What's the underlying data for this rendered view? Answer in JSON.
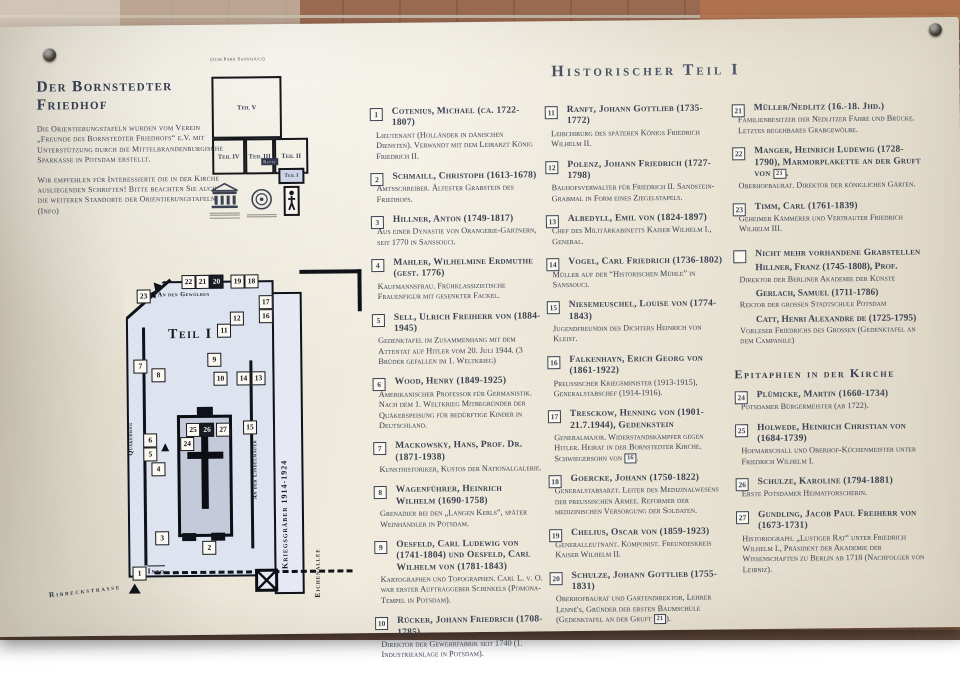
{
  "header": {
    "title": "Der Bornstedter Friedhof",
    "para1": "Die Orientierungstafeln wurden vom Verein „Freunde des Bornstedter Friedhofs“ e.V. mit Unterstützung durch die Mittelbrandenburgische Sparkasse in Potsdam erstellt.",
    "para2": "Wir empfehlen für Interessierte die in der Kirche ausliegenden Schriften! Bitte beachten Sie auch die weiteren Standorte der Orientierungstafeln (Info)"
  },
  "overview_map": {
    "caption": "(zum Park Sanssouci)",
    "rooms": {
      "v": "Teil V",
      "iv": "Teil IV",
      "iii": "Teil III",
      "ii": "Teil II"
    },
    "you_are_here": "Teil I",
    "small_label": "Kette"
  },
  "main_title": "Historischer Teil I",
  "columns": {
    "col1": [
      {
        "n": "1",
        "name": "Cotenius, Michael (ca. 1722-1807)",
        "desc": "Lieutenant (Holländer in dänischen Diensten). Verwandt mit dem Leibarzt König Friedrich II."
      },
      {
        "n": "2",
        "name": "Schmaill, Christoph (1613-1678)",
        "desc": "Amtsschreiber. Ältester Grabstein des Friedhofs."
      },
      {
        "n": "3",
        "name": "Hillner, Anton (1749-1817)",
        "desc": "Aus einer Dynastie von Orangerie-Gärtnern, seit 1770 in Sanssouci."
      },
      {
        "n": "4",
        "name": "Mahler, Wilhelmine Erdmuthe (gest. 1776)",
        "desc": "Kaufmannsfrau. Frühklassizistische Frauenfigur mit gesenkter Fackel."
      },
      {
        "n": "5",
        "name": "Sell, Ulrich Freiherr von (1884-1945)",
        "desc": "Gedenktafel im Zusammenhang mit dem Attentat auf Hitler vom 20. Juli 1944. (3 Brüder gefallen im 1. Weltkrieg)"
      },
      {
        "n": "6",
        "name": "Wood, Henry (1849-1925)",
        "desc": "Amerikanischer Professor für Germanistik. Nach dem 1. Weltkrieg Mitbegründer der Quäkerspeisung für bedürftige Kinder in Deutschland."
      },
      {
        "n": "7",
        "name": "Mackowsky, Hans, Prof. Dr. (1871-1938)",
        "desc": "Kunsthistoriker, Kustos der Nationalgalerie."
      },
      {
        "n": "8",
        "name": "Wagenführer, Heinrich Wilhelm (1690-1758)",
        "desc": "Grenadier bei den „Langen Kerls“, später Weinhändler in Potsdam."
      },
      {
        "n": "9",
        "name": "Oesfeld, Carl Ludewig von (1741-1804) und Oesfeld, Carl Wilhelm von (1781-1843)",
        "desc": "Kartographen und Topographen. Carl L. v. O. war erster Auftraggeber Schinkels (Pomona-Tempel in Potsdam)."
      },
      {
        "n": "10",
        "name": "Rücker, Johann Friedrich (1708-1785)",
        "desc": "Direktor der Gewehrfabrik seit 1740 (1. Industrieanlage in Potsdam)."
      }
    ],
    "col2": [
      {
        "n": "11",
        "name": "Ranft, Johann Gottlieb (1735-1772)",
        "desc": "Leibchirurg des späteren Königs Friedrich Wilhelm II."
      },
      {
        "n": "12",
        "name": "Polenz, Johann Friedrich (1727-1798)",
        "desc": "Bauhofsverwalter für Friedrich II. Sandstein-Grabmal in Form eines Ziegelstapels."
      },
      {
        "n": "13",
        "name": "Albedyll, Emil von (1824-1897)",
        "desc": "Chef des Militärkabinetts Kaiser Wilhelm I., General."
      },
      {
        "n": "14",
        "name": "Vogel, Carl Friedrich (1736-1802)",
        "desc": "Müller auf der “Historischen Mühle” in Sanssouci."
      },
      {
        "n": "15",
        "name": "Niesemeuschel, Louise von (1774-1843)",
        "desc": "Jugendfreundin des Dichters Heinrich von Kleist."
      },
      {
        "n": "16",
        "name": "Falkenhayn, Erich Georg von (1861-1922)",
        "desc": "Preußischer Kriegsminister (1913-1915), Generalstabschef (1914-1916)."
      },
      {
        "n": "17",
        "name": "Tresckow, Henning von (1901-21.7.1944), Gedenkstein",
        "desc": "Generalmajor. Widerstandskämpfer gegen Hitler. Heirat in der Bornstedter Kirche. Schwiegersohn von [16]."
      },
      {
        "n": "18",
        "name": "Goercke, Johann (1750-1822)",
        "desc": "Generalstabsarzt. Leiter des Medizinalwesens der preußischen Armee. Reformer der medizinischen Versorgung der Soldaten."
      },
      {
        "n": "19",
        "name": "Chelius, Oscar von (1859-1923)",
        "desc": "Generalleutnant. Komponist. Freundeskreis Kaiser Wilhelm II."
      },
      {
        "n": "20",
        "name": "Schulze, Johann Gottlieb (1755-1831)",
        "desc": "Oberhofbaurat und Gartendirektor, Lehrer Lenné's, Gründer der ersten Baumschule (Gedenktafel an der Gruft [21])."
      }
    ],
    "col3": [
      {
        "n": "21",
        "name": "Müller/Nedlitz (16.-18. Jhd.)",
        "desc": "Familienbesitzer der Nedlitzer Fähre und Brücke. Letztes begehbares Grabgewölbe."
      },
      {
        "n": "22",
        "name": "Manger, Heinrich Ludewig (1728-1790), Marmorplakette an der Gruft von [21].",
        "desc": "Oberhofbaurat. Direktor der königlichen Gärten."
      },
      {
        "n": "23",
        "name": "Timm, Carl (1761-1839)",
        "desc": "Geheimer Kämmerer und Vertrauter Friedrich Wilhelm III."
      }
    ]
  },
  "missing_graves": {
    "title": "Nicht mehr vorhandene Grabstellen",
    "people": [
      {
        "name": "Hillner, Franz (1745-1808), Prof.",
        "desc": "Direktor der Berliner Akademie der Künste"
      },
      {
        "name": "Gerlach, Samuel (1711-1786)",
        "desc": "Rektor der großen Stadtschule Potsdam"
      },
      {
        "name": "Catt, Henri Alexandre de (1725-1795)",
        "desc": "Vorleser Friedrichs des Großen (Gedenktafel an dem Campanile)"
      }
    ]
  },
  "epitaphs": {
    "title": "Epitaphien in der Kirche",
    "entries": [
      {
        "n": "24",
        "name": "Plümicke, Martin (1660-1734)",
        "desc": "Potsdamer Bürgermeister (ab 1722)."
      },
      {
        "n": "25",
        "name": "Holwede, Heinrich Christian von (1684-1739)",
        "desc": "Hofmarschall und Oberhof-Küchenmeister unter Friedrich Wilhelm I."
      },
      {
        "n": "26",
        "name": "Schulze, Karoline (1794-1881)",
        "desc": "Erste Potsdamer Heimatforscherin."
      },
      {
        "n": "27",
        "name": "Gundling, Jacob Paul Freiherr von (1673-1731)",
        "desc": "Historiograph. „Lustiger Rat“ unter Friedrich Wilhelm I., Präsident der Akademie der Wissenschaften zu Berlin ab 1718 (Nachfolger von Leibniz)."
      }
    ]
  },
  "site_map": {
    "title": "Teil I",
    "labels": {
      "gewoelbe": "An den Gewölben",
      "quaekerweg": "Quäkerweg",
      "lindelmauer": "An der Lindelmauer",
      "kriegsgraeber": "Kriegsgräber  1914-1924",
      "eichenallee": "Eichenallee",
      "ribbeckstrasse": "Ribbeckstrasse",
      "info": "Info"
    },
    "markers": [
      {
        "n": "23",
        "x": 25,
        "y": 24
      },
      {
        "n": "22",
        "x": 70,
        "y": 10
      },
      {
        "n": "21",
        "x": 84,
        "y": 10
      },
      {
        "n": "20",
        "x": 98,
        "y": 10,
        "dark": true
      },
      {
        "n": "19",
        "x": 119,
        "y": 10
      },
      {
        "n": "18",
        "x": 133,
        "y": 10
      },
      {
        "n": "17",
        "x": 147,
        "y": 31
      },
      {
        "n": "16",
        "x": 147,
        "y": 45
      },
      {
        "n": "12",
        "x": 118,
        "y": 47
      },
      {
        "n": "11",
        "x": 105,
        "y": 59
      },
      {
        "n": "9",
        "x": 95,
        "y": 88
      },
      {
        "n": "7",
        "x": 21,
        "y": 94
      },
      {
        "n": "8",
        "x": 39,
        "y": 103
      },
      {
        "n": "10",
        "x": 101,
        "y": 107
      },
      {
        "n": "14",
        "x": 124,
        "y": 107
      },
      {
        "n": "13",
        "x": 139,
        "y": 107
      },
      {
        "n": "15",
        "x": 130,
        "y": 156
      },
      {
        "n": "25",
        "x": 73,
        "y": 158
      },
      {
        "n": "26",
        "x": 87,
        "y": 158,
        "dark": true
      },
      {
        "n": "27",
        "x": 103,
        "y": 158
      },
      {
        "n": "24",
        "x": 67,
        "y": 172
      },
      {
        "n": "6",
        "x": 30,
        "y": 168
      },
      {
        "n": "5",
        "x": 30,
        "y": 182
      },
      {
        "n": "4",
        "x": 38,
        "y": 197
      },
      {
        "n": "3",
        "x": 41,
        "y": 266
      },
      {
        "n": "2",
        "x": 88,
        "y": 276
      },
      {
        "n": "1",
        "x": 18,
        "y": 301
      }
    ]
  },
  "colors": {
    "panel": "#ece7d9",
    "text": "#3a4252",
    "map_bg": "#dde3ef",
    "brick": "#9a6a52"
  }
}
